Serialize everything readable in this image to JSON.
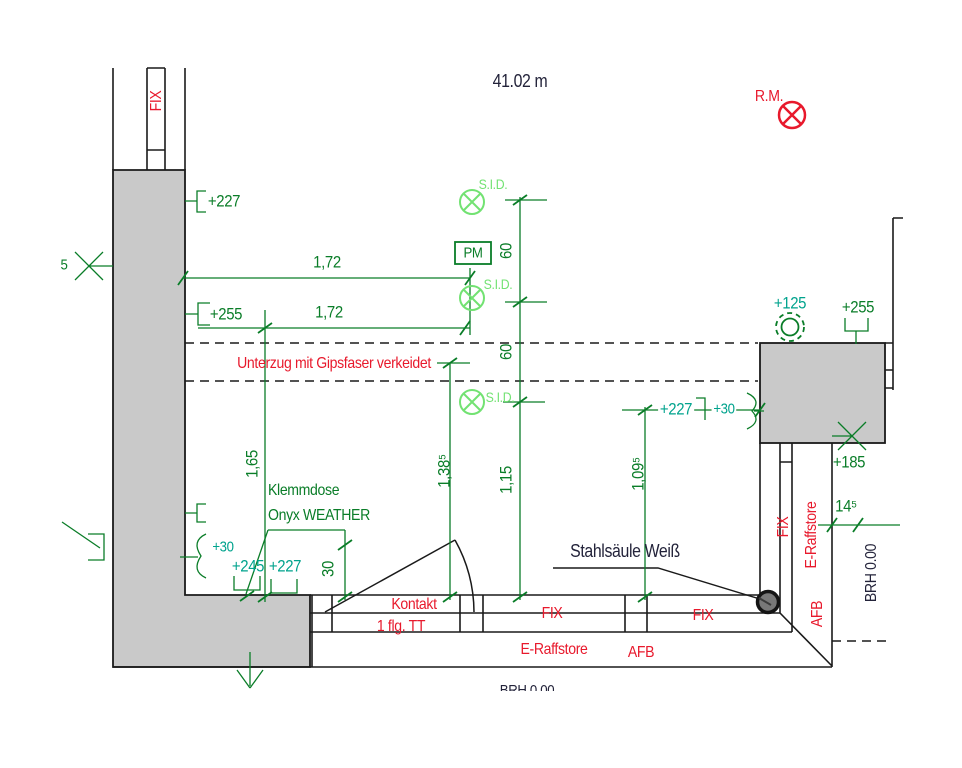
{
  "drawing": {
    "type": "architectural-plan-detail",
    "language": "de",
    "scale_note": "41.02 m"
  },
  "colors": {
    "green": "#0A7D28",
    "teal": "#00A38D",
    "light_green": "#72E272",
    "red": "#E8192C",
    "dark": "#23233A",
    "wall_fill": "#C9C9C9",
    "line": "#1A1A1A",
    "column_fill": "#787878"
  },
  "symbols": [
    {
      "id": "sid-device-symbol-1",
      "shape": "circle-x",
      "color": "light_green"
    },
    {
      "id": "sid-device-symbol-2",
      "shape": "circle-x",
      "color": "light_green"
    },
    {
      "id": "sid-device-symbol-3",
      "shape": "circle-x",
      "color": "light_green"
    },
    {
      "id": "pm-box",
      "shape": "rectangle",
      "color": "green"
    },
    {
      "id": "rm-device-symbol",
      "shape": "circle-x",
      "color": "red"
    },
    {
      "id": "level-125-symbol",
      "shape": "double-circle-dashed",
      "color": "green"
    },
    {
      "id": "steel-column-dot",
      "shape": "filled-circle",
      "color": "column_fill"
    },
    {
      "id": "door-swing",
      "shape": "leaf-and-arc",
      "color": "line"
    },
    {
      "id": "axis-cross-left",
      "shape": "x-cross",
      "color": "green"
    },
    {
      "id": "axis-cross-right",
      "shape": "x-cross",
      "color": "green"
    },
    {
      "id": "direction-arrow-down",
      "shape": "arrow",
      "color": "green"
    }
  ],
  "labels": [
    {
      "id": "scale-note",
      "text": "41.02 m",
      "x": 520,
      "y": 81,
      "size": 18,
      "color": "dark"
    },
    {
      "id": "rm-note",
      "text": "R.M.",
      "x": 769,
      "y": 97,
      "size": 16,
      "color": "red"
    },
    {
      "id": "sid-note-1",
      "text": "S.I.D.",
      "x": 493,
      "y": 184,
      "size": 14,
      "color": "light_green"
    },
    {
      "id": "sid-note-2",
      "text": "S.I.D.",
      "x": 498,
      "y": 284,
      "size": 14,
      "color": "light_green"
    },
    {
      "id": "sid-note-3",
      "text": "S.I.D.",
      "x": 500,
      "y": 397,
      "size": 14,
      "color": "light_green"
    },
    {
      "id": "pm-box-label",
      "text": "PM",
      "x": 473,
      "y": 253,
      "size": 15,
      "color": "green"
    },
    {
      "id": "level-227-top-left",
      "text": "+227",
      "x": 224,
      "y": 201,
      "size": 17,
      "color": "green"
    },
    {
      "id": "dim-172-upper",
      "text": "1,72",
      "x": 327,
      "y": 262,
      "size": 17,
      "color": "green"
    },
    {
      "id": "level-255-left",
      "text": "+255",
      "x": 226,
      "y": 314,
      "size": 17,
      "color": "green"
    },
    {
      "id": "dim-172-lower",
      "text": "1,72",
      "x": 329,
      "y": 312,
      "size": 17,
      "color": "green"
    },
    {
      "id": "unterzug-note",
      "text": "Unterzug mit Gipsfaser verkeidet",
      "x": 334,
      "y": 364,
      "size": 16,
      "color": "red"
    },
    {
      "id": "level-125",
      "text": "+125",
      "x": 790,
      "y": 303,
      "size": 17,
      "color": "teal"
    },
    {
      "id": "level-255-right",
      "text": "+255",
      "x": 858,
      "y": 307,
      "size": 17,
      "color": "green"
    },
    {
      "id": "dim-60-upper",
      "text": "60",
      "x": 506,
      "y": 251,
      "size": 17,
      "color": "green",
      "rot": -90
    },
    {
      "id": "dim-60-lower",
      "text": "60",
      "x": 506,
      "y": 352,
      "size": 17,
      "color": "green",
      "rot": -90
    },
    {
      "id": "level-227-mid",
      "text": "+227",
      "x": 676,
      "y": 409,
      "size": 17,
      "color": "teal",
      "bg": true
    },
    {
      "id": "level-30-mid",
      "text": "+30",
      "x": 724,
      "y": 409,
      "size": 15,
      "color": "teal",
      "bg": true
    },
    {
      "id": "dim-165",
      "text": "1,65",
      "x": 252,
      "y": 464,
      "size": 17,
      "color": "green",
      "rot": -90
    },
    {
      "id": "klemmdose-note-line1",
      "text": "Klemmdose",
      "x": 268,
      "y": 491,
      "size": 16,
      "color": "green",
      "align": "left"
    },
    {
      "id": "klemmdose-note-line2",
      "text": "Onyx WEATHER",
      "x": 268,
      "y": 516,
      "size": 16,
      "color": "green",
      "align": "left"
    },
    {
      "id": "dim-138",
      "text": "1,38⁵",
      "x": 444,
      "y": 471,
      "size": 17,
      "color": "green",
      "rot": -90
    },
    {
      "id": "dim-115",
      "text": "1,15",
      "x": 506,
      "y": 480,
      "size": 17,
      "color": "green",
      "rot": -90
    },
    {
      "id": "dim-109",
      "text": "1,09⁵",
      "x": 638,
      "y": 474,
      "size": 17,
      "color": "green",
      "rot": -90
    },
    {
      "id": "level-30-left",
      "text": "+30",
      "x": 223,
      "y": 547,
      "size": 15,
      "color": "teal"
    },
    {
      "id": "level-245-bottom",
      "text": "+245",
      "x": 248,
      "y": 566,
      "size": 17,
      "color": "teal"
    },
    {
      "id": "level-227-bottom",
      "text": "+227",
      "x": 285,
      "y": 566,
      "size": 17,
      "color": "teal"
    },
    {
      "id": "dim-30",
      "text": "30",
      "x": 328,
      "y": 569,
      "size": 17,
      "color": "green",
      "rot": -90
    },
    {
      "id": "kontakt-note",
      "text": "Kontakt",
      "x": 414,
      "y": 605,
      "size": 16,
      "color": "red"
    },
    {
      "id": "door-type-note",
      "text": "1 flg. TT",
      "x": 401,
      "y": 627,
      "size": 16,
      "color": "red"
    },
    {
      "id": "stahlsaeule-note",
      "text": "Stahlsäule Weiß",
      "x": 625,
      "y": 551,
      "size": 18,
      "color": "dark"
    },
    {
      "id": "fix-bottom-left",
      "text": "FIX",
      "x": 552,
      "y": 614,
      "size": 16,
      "color": "red"
    },
    {
      "id": "fix-bottom-right",
      "text": "FIX",
      "x": 703,
      "y": 616,
      "size": 16,
      "color": "red"
    },
    {
      "id": "e-raffstore-bottom",
      "text": "E-Raffstore",
      "x": 554,
      "y": 650,
      "size": 16,
      "color": "red"
    },
    {
      "id": "afb-bottom",
      "text": "AFB",
      "x": 641,
      "y": 653,
      "size": 16,
      "color": "red"
    },
    {
      "id": "fix-top-left",
      "text": "FIX",
      "x": 157,
      "y": 101,
      "size": 16,
      "color": "red",
      "rot": -90
    },
    {
      "id": "fix-right",
      "text": "FIX",
      "x": 784,
      "y": 527,
      "size": 16,
      "color": "red",
      "rot": -90
    },
    {
      "id": "e-raffstore-right",
      "text": "E-Raffstore",
      "x": 812,
      "y": 535,
      "size": 16,
      "color": "red",
      "rot": -90
    },
    {
      "id": "afb-right",
      "text": "AFB",
      "x": 818,
      "y": 614,
      "size": 16,
      "color": "red",
      "rot": -90
    },
    {
      "id": "level-185",
      "text": "+185",
      "x": 849,
      "y": 462,
      "size": 17,
      "color": "green"
    },
    {
      "id": "dim-145",
      "text": "14⁵",
      "x": 846,
      "y": 506,
      "size": 17,
      "color": "green"
    },
    {
      "id": "brh-right",
      "text": "BRH 0.00",
      "x": 872,
      "y": 573,
      "size": 16,
      "color": "dark",
      "rot": -90
    },
    {
      "id": "brh-bottom-clipped",
      "text": "BRH 0.00",
      "x": 527,
      "y": 683,
      "size": 15,
      "color": "dark",
      "clip": 8
    },
    {
      "id": "edge-glyph",
      "text": "5",
      "x": 64,
      "y": 265,
      "size": 15,
      "color": "green"
    }
  ]
}
